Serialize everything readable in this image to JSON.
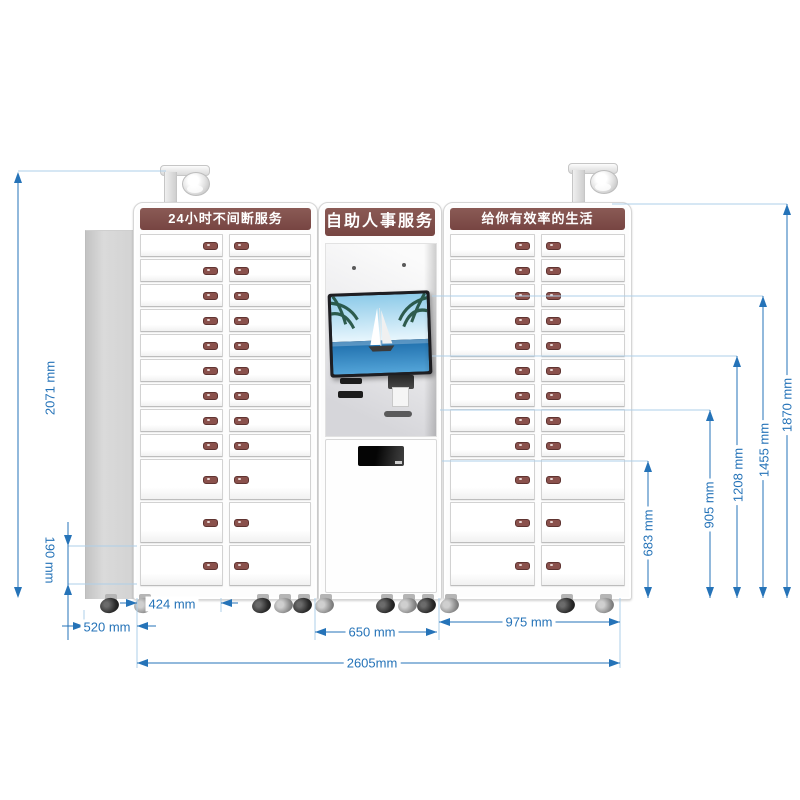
{
  "banners": {
    "left": "24小时不间断服务",
    "center": "自助人事服务",
    "right": "给你有效率的生活"
  },
  "dimensions": {
    "d2071": "2071 mm",
    "d190": "190 mm",
    "d520": "520 mm",
    "d424": "424 mm",
    "d650": "650 mm",
    "d975": "975 mm",
    "d2605": "2605mm",
    "d683": "683 mm",
    "d905": "905 mm",
    "d1208": "1208 mm",
    "d1455": "1455 mm",
    "d1870": "1870 mm"
  },
  "lockers": {
    "columns_per_cabinet": 2,
    "small_rows_per_column": 9,
    "large_rows_per_column": 3
  },
  "colors": {
    "banner_maroon": "#7a4945",
    "dimension_blue": "#2573b8",
    "leader_blue": "#aecfe8",
    "handle_maroon": "#8a514c"
  },
  "icons": {
    "camera": "cctv-dome-camera-icon",
    "wheel": "caster-wheel-icon",
    "handle": "locker-handle-icon"
  }
}
